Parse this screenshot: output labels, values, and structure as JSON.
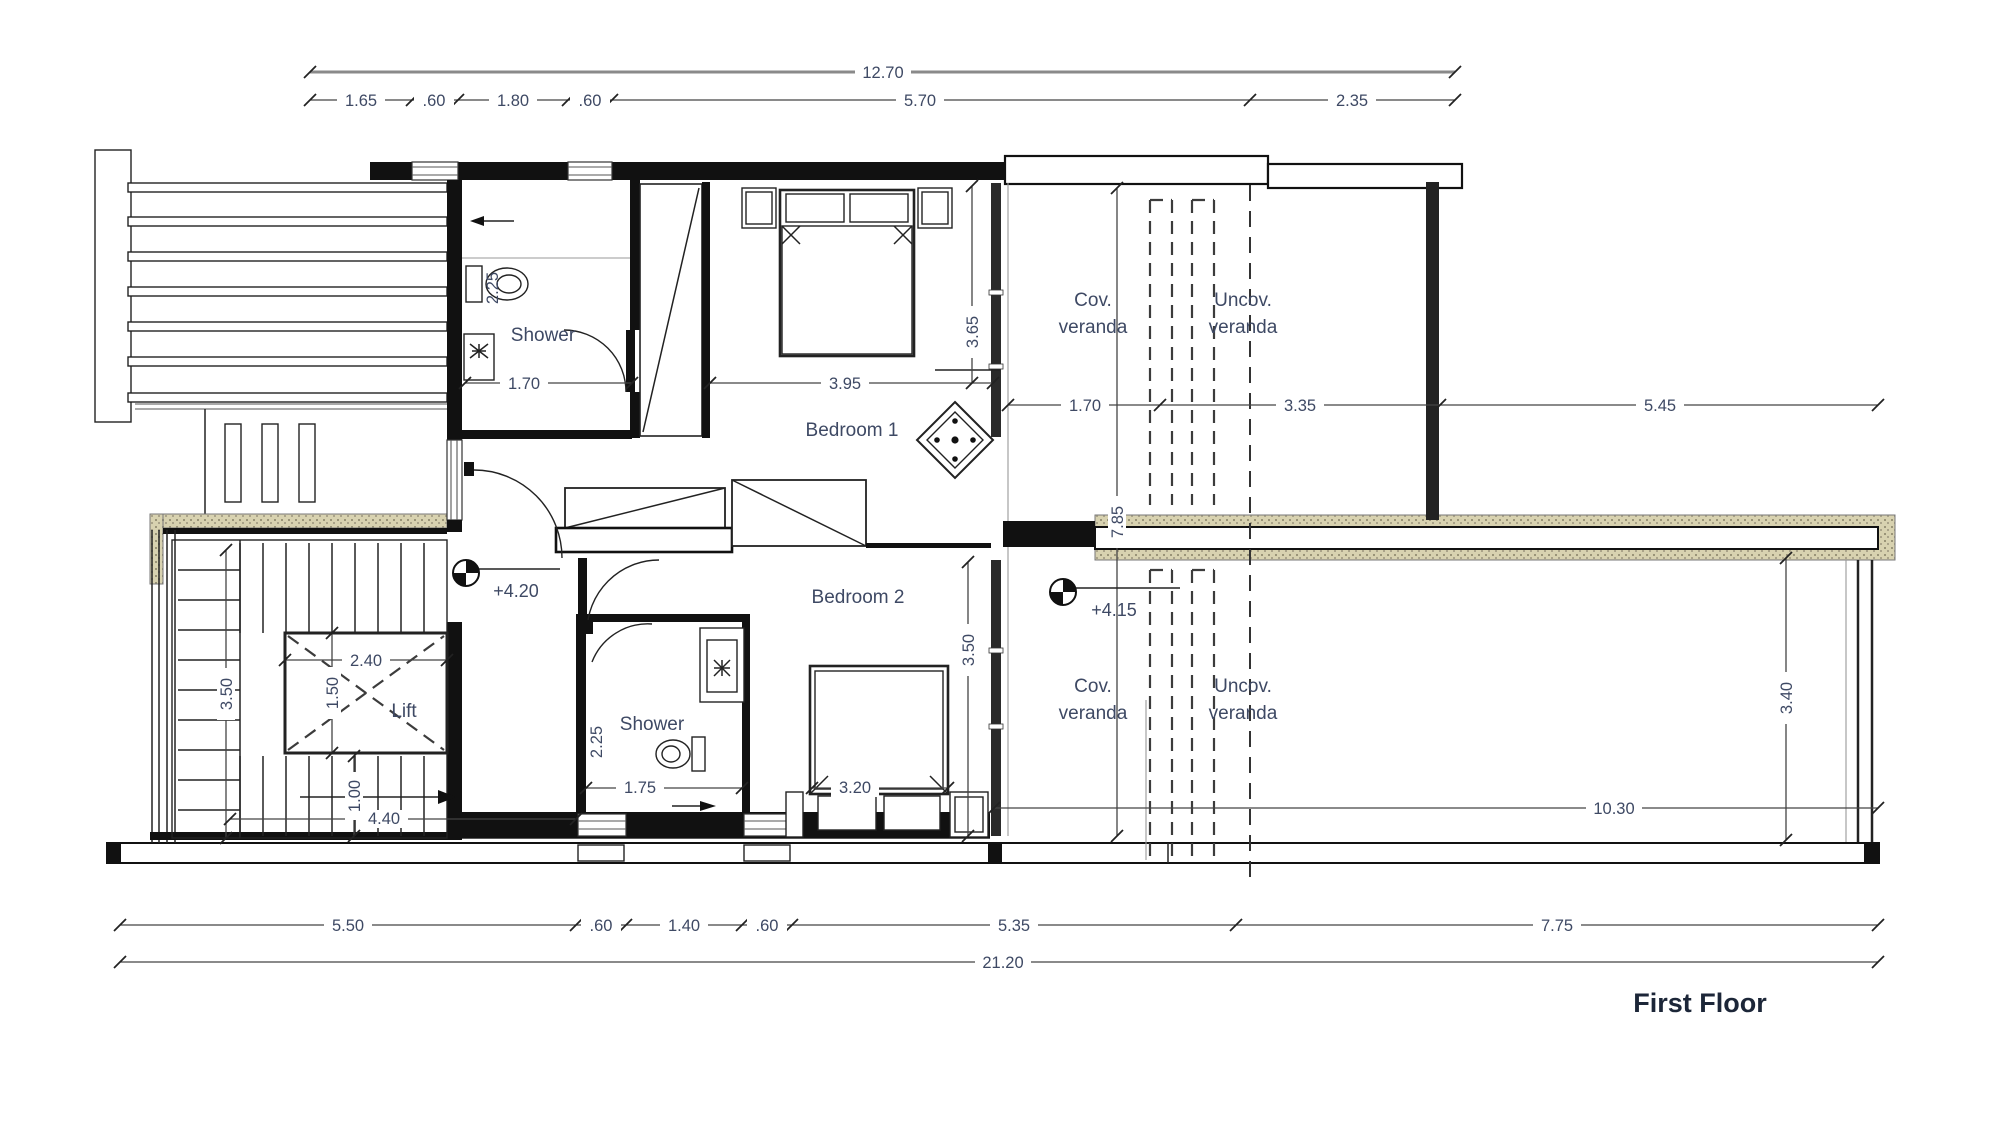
{
  "title": "First Floor",
  "labels": {
    "shower_top": "Shower",
    "shower_bottom": "Shower",
    "bedroom1": "Bedroom 1",
    "bedroom2": "Bedroom 2",
    "lift": "Lift",
    "cov_top": [
      "Cov.",
      "veranda"
    ],
    "uncov_top": [
      "Uncov.",
      "veranda"
    ],
    "cov_bottom": [
      "Cov.",
      "veranda"
    ],
    "uncov_bottom": [
      "Uncov.",
      "veranda"
    ]
  },
  "levels": {
    "hall": "+4.20",
    "veranda": "+4.15"
  },
  "dims": {
    "top_overall": "12.70",
    "top_row": [
      "1.65",
      ".60",
      "1.80",
      ".60",
      "5.70",
      "2.35"
    ],
    "bottom_row": [
      "5.50",
      ".60",
      "1.40",
      ".60",
      "5.35",
      "7.75"
    ],
    "bottom_overall": "21.20",
    "veranda_row": [
      "1.70",
      "3.35",
      "5.45"
    ],
    "bed1_width": "3.95",
    "bed1_depth": "3.65",
    "shower_top_width": "1.70",
    "shower_top_depth": "2.25",
    "veranda_depth": "7.85",
    "stair_width": "3.50",
    "stair_run": "4.40",
    "stair_exit": "1.00",
    "lift_width": "2.40",
    "lift_depth": "1.50",
    "shower_bottom_width": "1.75",
    "shower_bottom_depth": "2.25",
    "bed2_width": "3.20",
    "bed2_depth": "3.50",
    "lower_veranda_width": "10.30",
    "balcony_depth": "3.40"
  },
  "colors": {
    "wall": "#111111",
    "text": "#3e4964",
    "hatch": "#d8d2b0",
    "title": "#1c2638"
  }
}
